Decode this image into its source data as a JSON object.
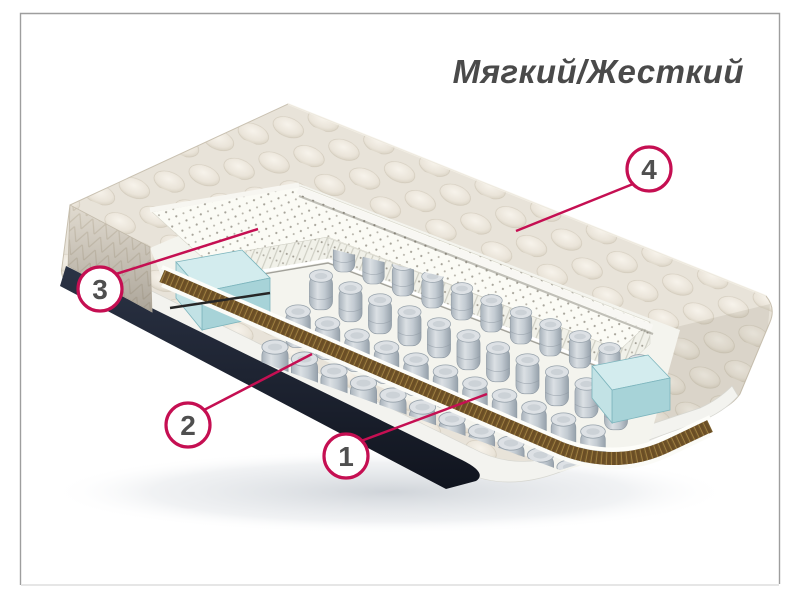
{
  "title": {
    "text": "Мягкий/Жесткий"
  },
  "diagram": {
    "type": "mattress-cutaway-product-diagram",
    "callouts": [
      {
        "number": "1",
        "target": "pocket-springs"
      },
      {
        "number": "2",
        "target": "coir-layer"
      },
      {
        "number": "3",
        "target": "perforated-latex-layer"
      },
      {
        "number": "4",
        "target": "quilted-top-cover"
      }
    ]
  },
  "colors": {
    "callout_accent": "#c50f52",
    "callout_number": "#4f4f4f",
    "title_text": "#4a4a4a",
    "quilt_fabric": "#e8e3d9",
    "latex_white": "#fbfbf6",
    "foam_blue": "#bfe0e3",
    "springs_gray": "#c6cdd4",
    "coir_brown": "#6b4e25",
    "bottom_navy": "#1e2532",
    "frame_border": "#9e9e9e"
  }
}
